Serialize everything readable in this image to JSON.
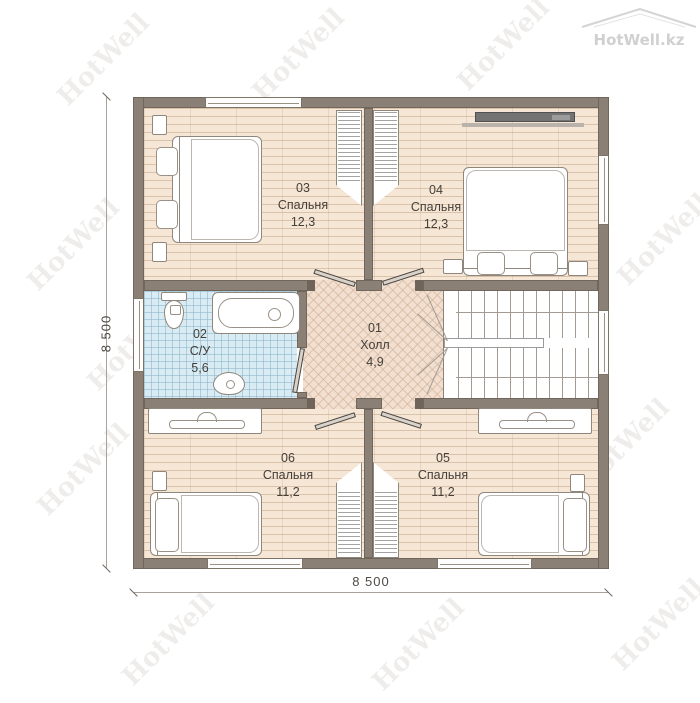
{
  "brand": {
    "logo_text": "HotWell.kz",
    "watermark_text": "HotWell"
  },
  "dimensions": {
    "left": "8 500",
    "bottom": "8 500"
  },
  "rooms": [
    {
      "number": "03",
      "name": "Спальня",
      "area": "12,3"
    },
    {
      "number": "04",
      "name": "Спальня",
      "area": "12,3"
    },
    {
      "number": "02",
      "name": "С/У",
      "area": "5,6"
    },
    {
      "number": "01",
      "name": "Холл",
      "area": "4,9"
    },
    {
      "number": "06",
      "name": "Спальня",
      "area": "11,2"
    },
    {
      "number": "05",
      "name": "Спальня",
      "area": "11,2"
    }
  ],
  "colors": {
    "wall": "#8b8075",
    "bedroom_floor": "#f5e6d5",
    "hall_floor": "#f2dfd0",
    "bathroom_floor": "#d9ebf3",
    "furniture_outline": "#8f877c",
    "tv": "#737373",
    "dimension_text": "#4f4a44",
    "watermark": "#8d8377"
  }
}
